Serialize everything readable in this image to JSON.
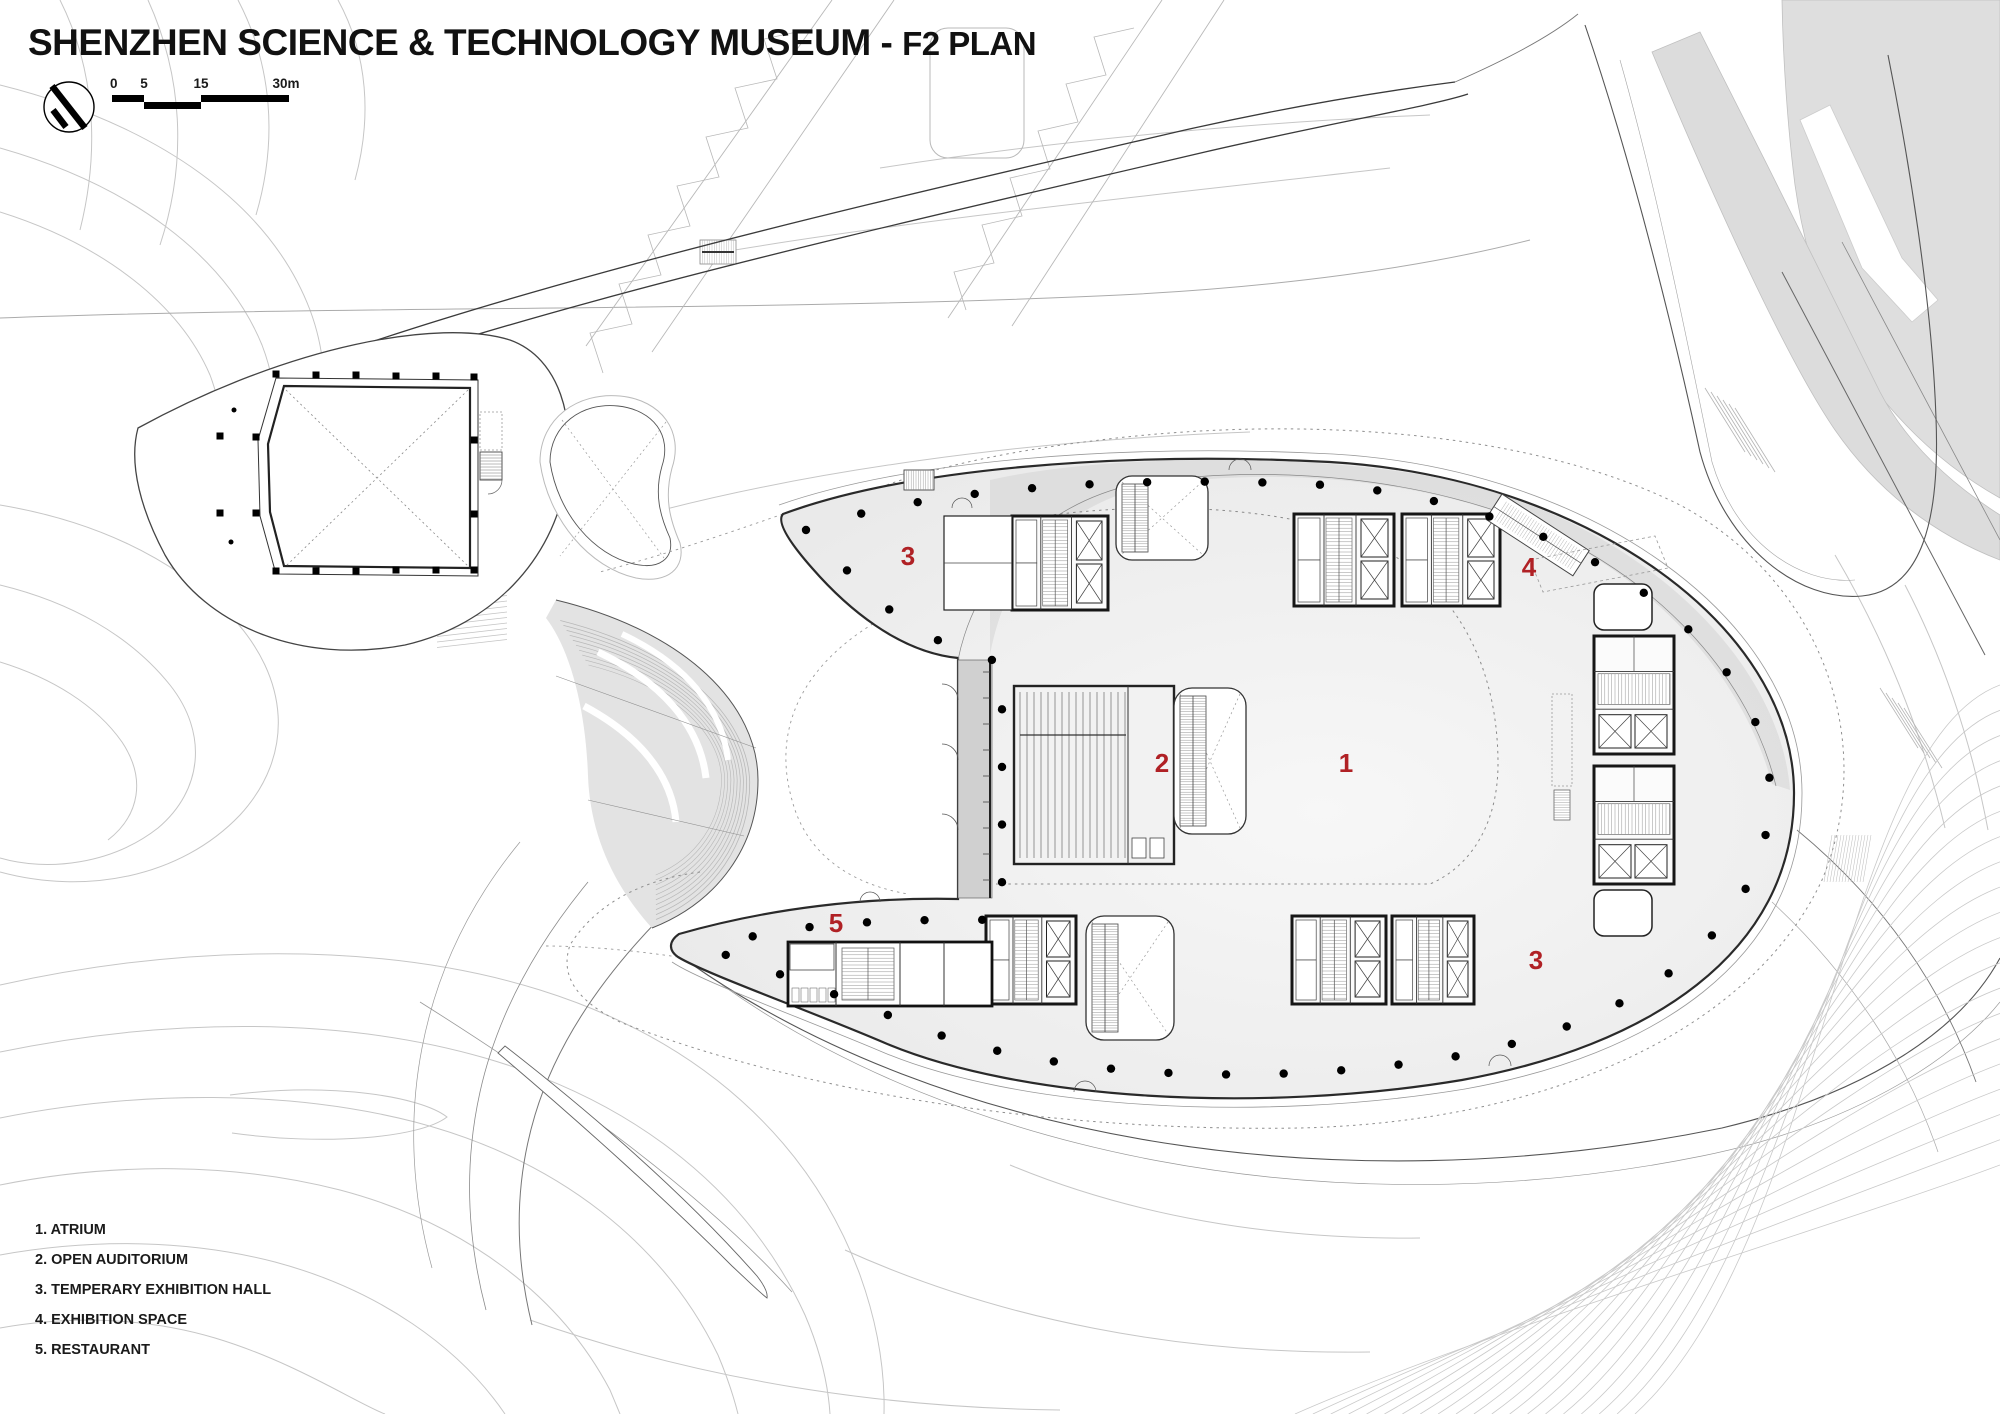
{
  "title": {
    "main": "SHENZHEN SCIENCE & TECHNOLOGY MUSEUM",
    "separator": " - ",
    "floor": "F2 PLAN"
  },
  "scale_bar": {
    "ticks": [
      "0",
      "5",
      "15",
      "30m"
    ]
  },
  "legend": {
    "items": [
      {
        "number": "1.",
        "label": "ATRIUM"
      },
      {
        "number": "2.",
        "label": "OPEN AUDITORIUM"
      },
      {
        "number": "3.",
        "label": "TEMPERARY EXHIBITION HALL"
      },
      {
        "number": "4.",
        "label": "EXHIBITION SPACE"
      },
      {
        "number": "5.",
        "label": "RESTAURANT"
      }
    ]
  },
  "plan_labels": [
    {
      "text": "3",
      "x": 908,
      "y": 556
    },
    {
      "text": "4",
      "x": 1529,
      "y": 567
    },
    {
      "text": "2",
      "x": 1162,
      "y": 763
    },
    {
      "text": "1",
      "x": 1346,
      "y": 763
    },
    {
      "text": "5",
      "x": 836,
      "y": 923
    },
    {
      "text": "3",
      "x": 1536,
      "y": 960
    }
  ],
  "colors": {
    "label_red": "#b02125",
    "wall": "#1c1c1c",
    "contour": "#c6c6c6",
    "floor_light": "#f7f7f7",
    "floor_dark": "#e7e7e7",
    "site_gray": "#dcdcdc",
    "band_gray": "#d7d7d7"
  }
}
